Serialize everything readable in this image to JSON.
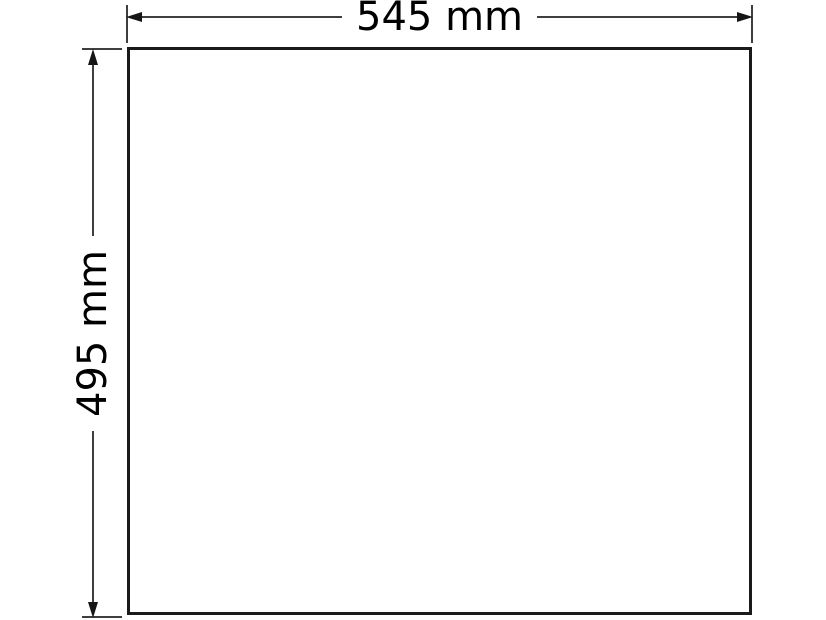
{
  "diagram": {
    "type": "dimension-drawing",
    "shape": "rectangle",
    "dimensions": {
      "width": {
        "label": "545 mm",
        "value": 545,
        "unit": "mm"
      },
      "height": {
        "label": "495 mm",
        "value": 495,
        "unit": "mm"
      }
    },
    "colors": {
      "background": "#ffffff",
      "outline": "#1a1a1a",
      "dimension_line": "#3f3f3f",
      "arrowhead": "#161616",
      "text": "#000000"
    }
  }
}
